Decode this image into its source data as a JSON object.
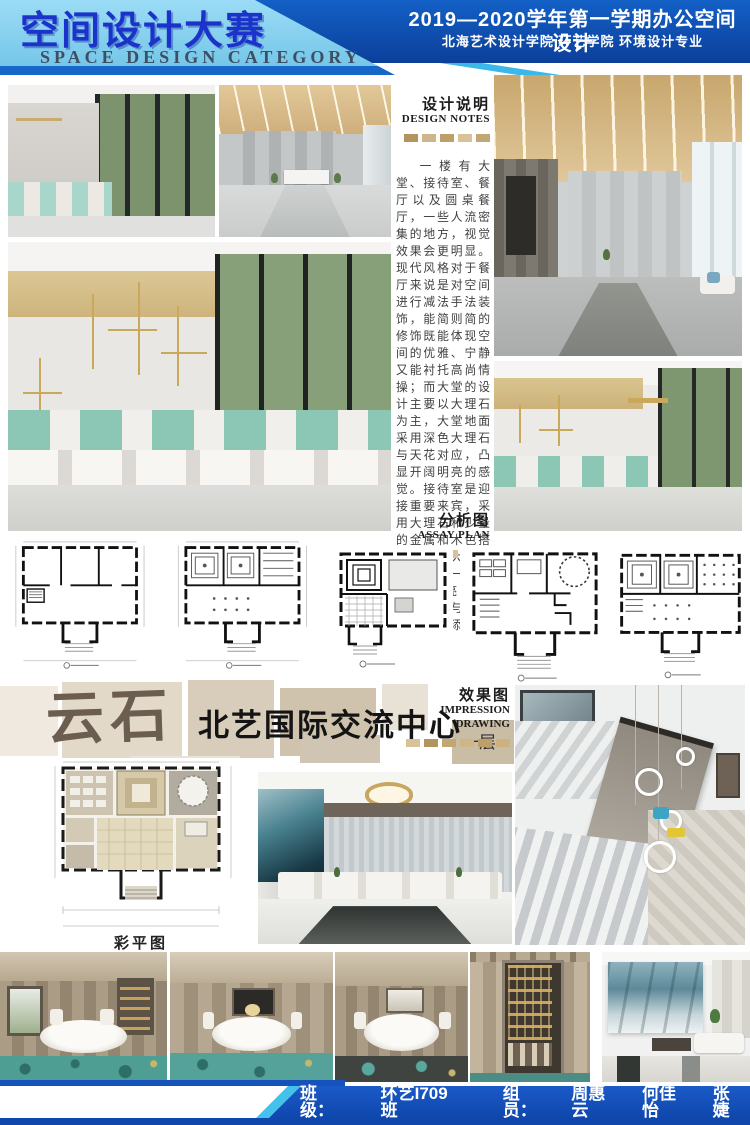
{
  "header": {
    "title": "空间设计大赛",
    "subtitle": "SPACE DESIGN CATEGORY",
    "course": "2019—2020学年第一学期办公空间设计",
    "department": "北海艺术设计学院 环艺学院 环境设计专业"
  },
  "design_notes": {
    "title_cn": "设计说明",
    "title_en": "DESIGN NOTES",
    "body": "一楼有大堂、接待室、餐厅以及圆桌餐厅，一些人流密集的地方，视觉效果会更明显。现代风格对于餐厅来说是对空间进行减法手法装饰，能简则简的修饰既能体现空间的优雅、宁静又能衬托高尚情操；而大堂的设计主要以大理石为主，大堂地面采用深色大理石与天花对应，凸显开阔明亮的感觉。接待室是迎接重要来宾，采用大理石和少量的金属和木色搭配，庄重大气。整体给人一种舒缓、明亮的气息，几何与线条的交汇增添了几分生机。"
  },
  "assay_plan": {
    "title_cn": "分析图",
    "title_en": "ASSAY PLAN"
  },
  "impression": {
    "title_cn": "效果图",
    "title_en": "IMPRESSION DRAWING"
  },
  "brand": {
    "logo": "云石",
    "center_name": "北艺国际交流中心",
    "floor_label": "一层"
  },
  "color_plan": {
    "caption": "彩平图"
  },
  "footer": {
    "class_label": "班级：",
    "class_value": "环艺I709班",
    "members_label": "组员：",
    "members": [
      "周惠云",
      "何佳怡",
      "张婕"
    ]
  },
  "colors": {
    "header_dark_blue": "#0f47ad",
    "header_light_blue": "#8fd4f0",
    "title_blue": "#1c33cb",
    "accent_cyan": "#45c2ec",
    "footer_blue": "#1552bb",
    "tan_square": "#c2a674",
    "beige_panel": "#e3d9c9",
    "logo_brown": "#6b5d50",
    "teal_furniture": "#8cc7b6"
  }
}
